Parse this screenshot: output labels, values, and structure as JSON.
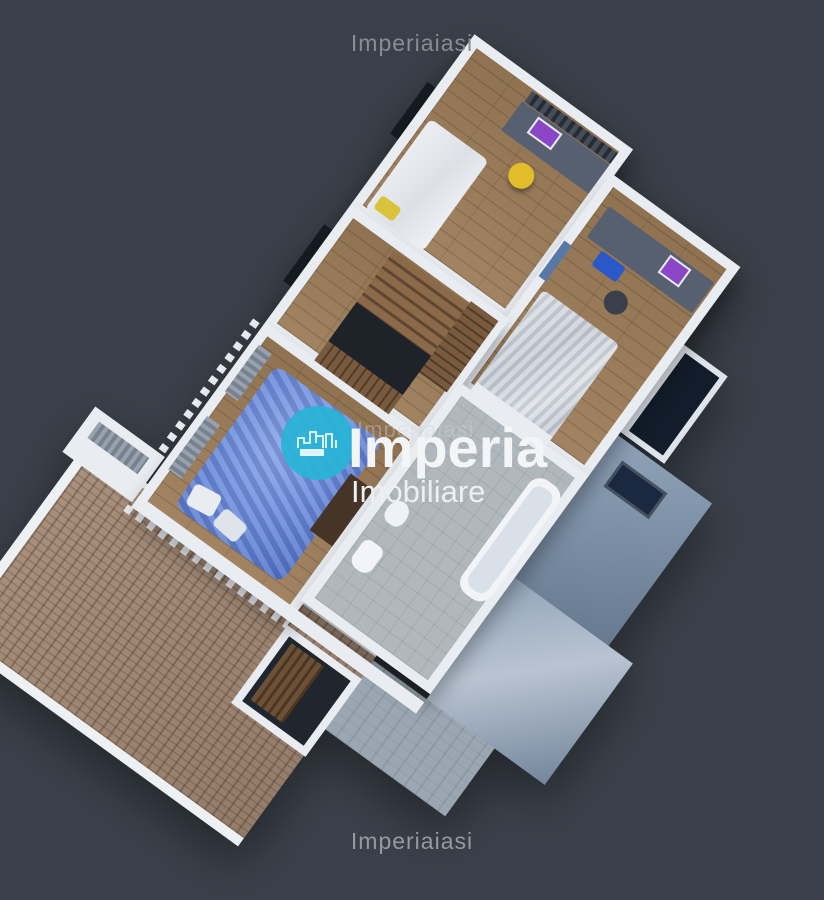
{
  "watermark": {
    "text": "Imperiaiasi"
  },
  "logo": {
    "brand": "Imperia",
    "tagline": "Imobiliare",
    "icon": "city-skyline-icon",
    "accent_color": "#29b4d7"
  },
  "palette": {
    "background": "#3a4049",
    "wall_white": "#e9edf2",
    "wood_floor": "#9c7c58",
    "roof_tiles": "#a48a76",
    "slate_roof": "#8094ac",
    "bathroom_tile": "#b0b7bd",
    "bed_blue": "#6f8fdd",
    "bed_gray": "#ccd2da",
    "desk_gray": "#566070",
    "monitor_purple": "#8b46c8",
    "chair_yellow": "#e2bc2a",
    "storage_bin_blue": "#2a58c8",
    "stair_wood": "#8a6a48",
    "window_glass_dark": "#161b22"
  }
}
